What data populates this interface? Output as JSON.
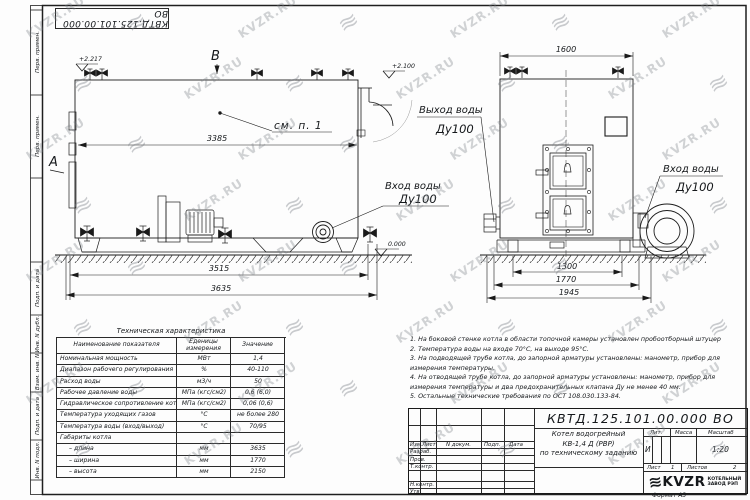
{
  "page": {
    "watermark_text": "KVZR.RU",
    "logo_glyph": "≋"
  },
  "frame": {
    "left_labels": [
      "Перв. примен.",
      "Перв. примен.",
      "Подп. и дата",
      "Инв. N дубл.",
      "Взам. инв. N",
      "Подп. и дата",
      "Инв. N подл."
    ]
  },
  "side_view": {
    "marker_top": "B",
    "marker_left": "A",
    "elev_top_left": "+2.217",
    "elev_top_right": "+2.100",
    "elev_ground": "0.000",
    "callout": "см. п. 1",
    "dim_body_length": "3385",
    "dim_base_length": "3515",
    "dim_overall_length": "3635",
    "inlet_label": "Вход воды",
    "inlet_dn": "Ду100"
  },
  "front_view": {
    "dim_width_top": "1600",
    "dim_base": "1300",
    "dim_mid": "1770",
    "dim_overall": "1945",
    "outlet_label": "Выход воды",
    "outlet_dn": "Ду100",
    "inlet_label": "Вход воды",
    "inlet_dn": "Ду100"
  },
  "spec_table": {
    "title": "Техническая характеристика",
    "headers": [
      "Наименование показателя",
      "Еденицы измерения",
      "Значение"
    ],
    "rows": [
      [
        "Номинальная мощность",
        "МВт",
        "1,4"
      ],
      [
        "Диапазон рабочего регулирования",
        "%",
        "40-110"
      ],
      [
        "Расход воды",
        "м3/ч",
        "50"
      ],
      [
        "Рабочее давление воды",
        "МПа (кгс/см2)",
        "0,6 (6,0)"
      ],
      [
        "Гидравлическое сопротивление котла",
        "МПа (кгс/см2)",
        "0,06 (0,6)"
      ],
      [
        "Температура уходящих газов",
        "°С",
        "не более 280"
      ],
      [
        "Температура воды (вход/выход)",
        "°С",
        "70/95"
      ],
      [
        "Габариты котла",
        "",
        ""
      ],
      [
        "– длина",
        "мм",
        "3635"
      ],
      [
        "– ширина",
        "мм",
        "1770"
      ],
      [
        "– высота",
        "мм",
        "2150"
      ]
    ]
  },
  "notes": [
    "1.  На боковой стенке котла в области топочной камеры установлен пробоотборный штуцер",
    "2.  Температура воды на входе 70°С, на выходе 95°С.",
    "3.  На подводящей трубе котла, до запорной арматуры установлены: манометр, прибор для измерения температуры.",
    "4.  На отводящей трубе котла, до запорной арматуры установлены: манометр, прибор для измерения температуры и два предохранительных клапана Ду не менее 40 мм.",
    "5.  Остальные технические требования по ОСТ 108.030.133-84."
  ],
  "title_block": {
    "doc_number": "КВТД.125.101.00.000  ВО",
    "col_headers": [
      "Изм.",
      "Лист",
      "N докум.",
      "Подп.",
      "Дата"
    ],
    "row_labels": [
      "Разраб.",
      "Пров.",
      "Т.контр.",
      "Н.контр.",
      "Утв."
    ],
    "title_line1": "Котел водогрейный",
    "title_line2": "КВ-1,4  Д (РВР)",
    "title_line3": "по техническому заданию",
    "lit_header": "Лит.",
    "mass_header": "Масса",
    "scale_header": "Масштаб",
    "lit_value": "И",
    "scale_value": "1:20",
    "sheet_label": "Лист",
    "sheet_value": "1",
    "sheets_label": "Листов",
    "sheets_value": "2",
    "company_name": "KVZR",
    "company_line1": "КОТЕЛЬНЫЙ",
    "company_line2": "ЗАВОД РЭП",
    "format_label": "Формат  А3"
  }
}
